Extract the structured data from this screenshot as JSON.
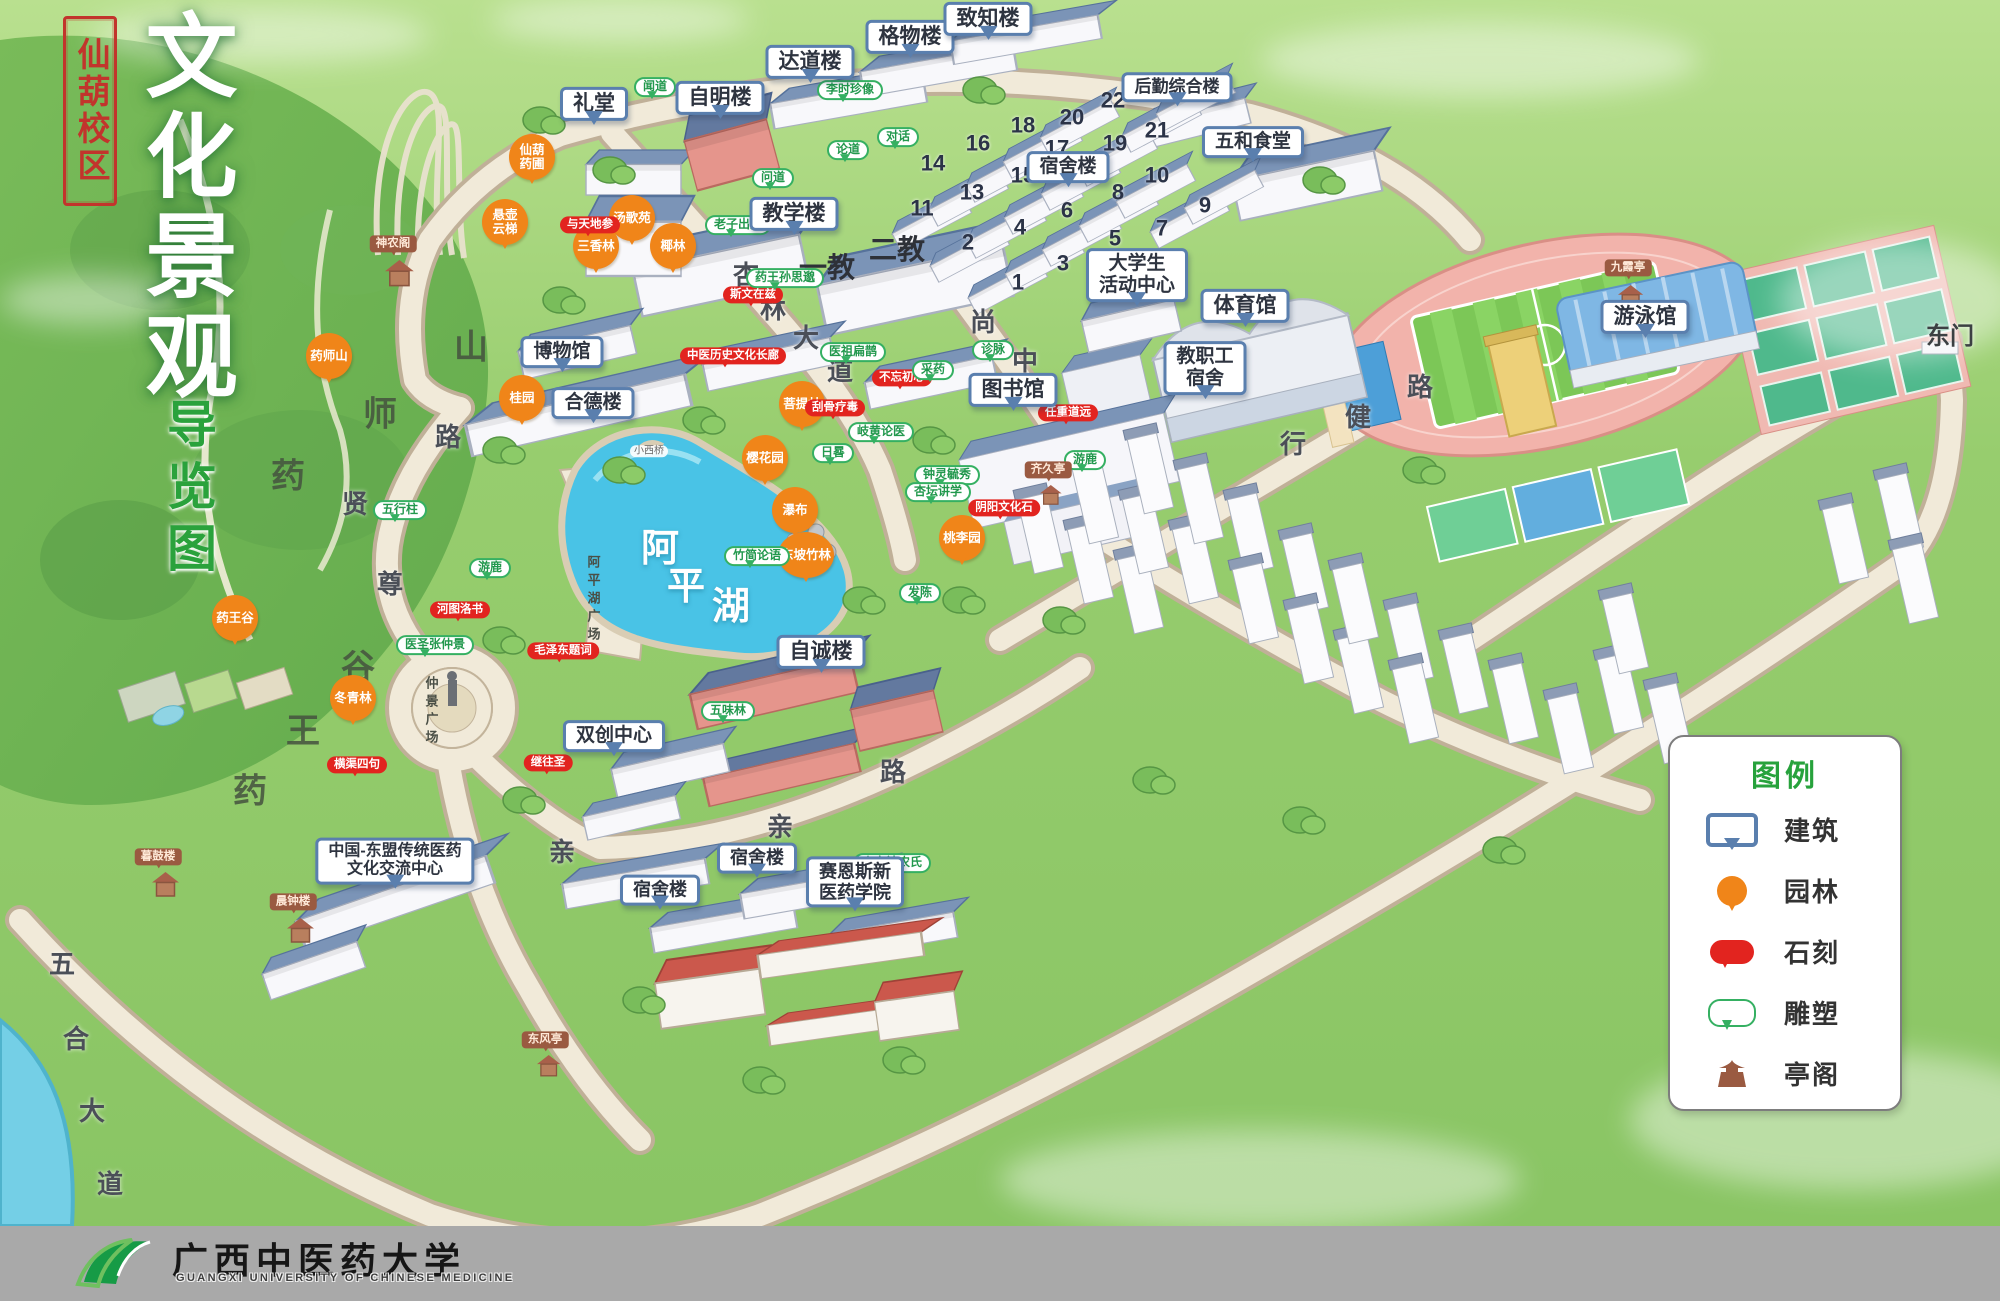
{
  "title": {
    "campus": "仙葫校区",
    "main": "文化景观",
    "sub": "导览图"
  },
  "legend": {
    "title": "图例",
    "items": [
      {
        "icon": "building-callout-icon",
        "label": "建筑"
      },
      {
        "icon": "garden-pin-icon",
        "label": "园林"
      },
      {
        "icon": "stone-bubble-icon",
        "label": "石刻"
      },
      {
        "icon": "sculpture-bubble-icon",
        "label": "雕塑"
      },
      {
        "icon": "pavilion-icon",
        "label": "亭阁"
      }
    ]
  },
  "footer": {
    "university": "广西中医药大学",
    "university_en": "GUANGXI UNIVERSITY OF CHINESE MEDICINE"
  },
  "lake": {
    "name": "阿平湖",
    "plaza": "阿平湖广场",
    "bridge": "小西桥"
  },
  "plaza": {
    "name": "仲景广场"
  },
  "colors": {
    "building_border": "#5a7fae",
    "garden_pin": "#f08519",
    "stone_label": "#e2241f",
    "sculpture_label": "#35b062",
    "pavilion_label": "#9a5a41",
    "legend_green": "#27a23c",
    "seal_red": "#c2342c",
    "footer_bar": "#a9a9a9",
    "lake": "#49c3e6",
    "road": "#f0e9d8",
    "grass": "#96cb6d"
  },
  "markers": {
    "buildings": [
      {
        "label": "礼堂",
        "x": 594,
        "y": 104
      },
      {
        "label": "自明楼",
        "x": 720,
        "y": 98
      },
      {
        "label": "达道楼",
        "x": 810,
        "y": 62
      },
      {
        "label": "格物楼",
        "x": 910,
        "y": 37
      },
      {
        "label": "致知楼",
        "x": 988,
        "y": 19
      },
      {
        "label": "后勤综合楼",
        "x": 1177,
        "y": 87,
        "fs": 17
      },
      {
        "label": "五和食堂",
        "x": 1253,
        "y": 142,
        "fs": 19
      },
      {
        "label": "宿舍楼",
        "x": 1068,
        "y": 167,
        "fs": 19
      },
      {
        "label": "教学楼",
        "x": 794,
        "y": 214
      },
      {
        "label": "大学生\n活动中心",
        "x": 1137,
        "y": 275,
        "fs": 19
      },
      {
        "label": "体育馆",
        "x": 1245,
        "y": 306
      },
      {
        "label": "图书馆",
        "x": 1013,
        "y": 390
      },
      {
        "label": "游泳馆",
        "x": 1645,
        "y": 317
      },
      {
        "label": "教职工\n宿舍",
        "x": 1205,
        "y": 368,
        "fs": 19
      },
      {
        "label": "自诚楼",
        "x": 821,
        "y": 652
      },
      {
        "label": "双创中心",
        "x": 614,
        "y": 736,
        "fs": 19
      },
      {
        "label": "宿舍楼",
        "x": 660,
        "y": 890,
        "fs": 18
      },
      {
        "label": "宿舍楼",
        "x": 757,
        "y": 858,
        "fs": 18
      },
      {
        "label": "赛恩斯新\n医药学院",
        "x": 855,
        "y": 882,
        "fs": 18
      },
      {
        "label": "博物馆",
        "x": 562,
        "y": 352,
        "fs": 19
      },
      {
        "label": "合德楼",
        "x": 593,
        "y": 403,
        "fs": 19
      },
      {
        "label": "中国-东盟传统医药\n文化交流中心",
        "x": 395,
        "y": 861,
        "fs": 16
      }
    ],
    "gardens": [
      {
        "label": "仙葫\n药圃",
        "x": 532,
        "y": 157
      },
      {
        "label": "悬壶\n云梯",
        "x": 505,
        "y": 222
      },
      {
        "label": "汤歌苑",
        "x": 632,
        "y": 218
      },
      {
        "label": "三香林",
        "x": 596,
        "y": 246
      },
      {
        "label": "椰林",
        "x": 673,
        "y": 246
      },
      {
        "label": "药师山",
        "x": 329,
        "y": 356
      },
      {
        "label": "桂园",
        "x": 522,
        "y": 398
      },
      {
        "label": "菩提林",
        "x": 802,
        "y": 404
      },
      {
        "label": "樱花园",
        "x": 765,
        "y": 458
      },
      {
        "label": "瀑布",
        "x": 795,
        "y": 510
      },
      {
        "label": "桃李园",
        "x": 962,
        "y": 538
      },
      {
        "label": "东坡竹林",
        "x": 806,
        "y": 555
      },
      {
        "label": "药王谷",
        "x": 235,
        "y": 618
      },
      {
        "label": "冬青林",
        "x": 353,
        "y": 698
      }
    ],
    "stones": [
      {
        "label": "与天地参",
        "x": 590,
        "y": 225
      },
      {
        "label": "斯文在兹",
        "x": 753,
        "y": 295
      },
      {
        "label": "中医历史文化长廊",
        "x": 733,
        "y": 356
      },
      {
        "label": "不忘初心",
        "x": 902,
        "y": 378
      },
      {
        "label": "刮骨疗毒",
        "x": 835,
        "y": 408
      },
      {
        "label": "任重道远",
        "x": 1068,
        "y": 413
      },
      {
        "label": "阴阳文化石",
        "x": 1004,
        "y": 508
      },
      {
        "label": "河图洛书",
        "x": 460,
        "y": 610
      },
      {
        "label": "毛泽东题词",
        "x": 563,
        "y": 651
      },
      {
        "label": "横渠四句",
        "x": 357,
        "y": 765
      },
      {
        "label": "继往圣",
        "x": 548,
        "y": 763
      }
    ],
    "sculptures": [
      {
        "label": "闻道",
        "x": 655,
        "y": 87
      },
      {
        "label": "李时珍像",
        "x": 850,
        "y": 90
      },
      {
        "label": "对话",
        "x": 898,
        "y": 137
      },
      {
        "label": "论道",
        "x": 848,
        "y": 150
      },
      {
        "label": "问道",
        "x": 773,
        "y": 178
      },
      {
        "label": "老子出关",
        "x": 738,
        "y": 225
      },
      {
        "label": "药王孙思邈",
        "x": 785,
        "y": 278
      },
      {
        "label": "医祖扁鹊",
        "x": 853,
        "y": 352
      },
      {
        "label": "诊脉",
        "x": 993,
        "y": 350
      },
      {
        "label": "采药",
        "x": 933,
        "y": 370
      },
      {
        "label": "岐黄论医",
        "x": 881,
        "y": 432
      },
      {
        "label": "日晷",
        "x": 833,
        "y": 453
      },
      {
        "label": "游鹿",
        "x": 1085,
        "y": 460
      },
      {
        "label": "钟灵毓秀",
        "x": 947,
        "y": 475
      },
      {
        "label": "杏坛讲学",
        "x": 938,
        "y": 492
      },
      {
        "label": "五行柱",
        "x": 400,
        "y": 510
      },
      {
        "label": "竹简论语",
        "x": 757,
        "y": 556
      },
      {
        "label": "游鹿",
        "x": 490,
        "y": 568
      },
      {
        "label": "发陈",
        "x": 920,
        "y": 593
      },
      {
        "label": "医圣张仲景",
        "x": 435,
        "y": 645
      },
      {
        "label": "五味林",
        "x": 728,
        "y": 711
      },
      {
        "label": "炎帝神农氏",
        "x": 892,
        "y": 863
      }
    ],
    "pavilions": [
      {
        "label": "神农阁",
        "x": 393,
        "y": 244
      },
      {
        "label": "九霞亭",
        "x": 1628,
        "y": 268
      },
      {
        "label": "齐久亭",
        "x": 1048,
        "y": 470
      },
      {
        "label": "东风亭",
        "x": 545,
        "y": 1040
      },
      {
        "label": "暮鼓楼",
        "x": 158,
        "y": 857
      },
      {
        "label": "晨钟楼",
        "x": 293,
        "y": 902
      }
    ],
    "road_chars": [
      {
        "ch": "杏",
        "x": 746,
        "y": 276
      },
      {
        "ch": "林",
        "x": 773,
        "y": 310
      },
      {
        "ch": "大",
        "x": 806,
        "y": 339
      },
      {
        "ch": "道",
        "x": 840,
        "y": 372
      },
      {
        "ch": "尚",
        "x": 983,
        "y": 323
      },
      {
        "ch": "中",
        "x": 1025,
        "y": 362
      },
      {
        "ch": "行",
        "x": 1293,
        "y": 445
      },
      {
        "ch": "健",
        "x": 1358,
        "y": 418
      },
      {
        "ch": "路",
        "x": 1420,
        "y": 388
      },
      {
        "ch": "路",
        "x": 448,
        "y": 438
      },
      {
        "ch": "贤",
        "x": 355,
        "y": 505
      },
      {
        "ch": "尊",
        "x": 390,
        "y": 585
      },
      {
        "ch": "亲",
        "x": 562,
        "y": 853
      },
      {
        "ch": "亲",
        "x": 780,
        "y": 828
      },
      {
        "ch": "路",
        "x": 893,
        "y": 773
      },
      {
        "ch": "五",
        "x": 62,
        "y": 965
      },
      {
        "ch": "合",
        "x": 76,
        "y": 1040
      },
      {
        "ch": "大",
        "x": 92,
        "y": 1112
      },
      {
        "ch": "道",
        "x": 110,
        "y": 1185
      }
    ],
    "terrain_chars": [
      {
        "ch": "药",
        "x": 288,
        "y": 477
      },
      {
        "ch": "师",
        "x": 380,
        "y": 415
      },
      {
        "ch": "山",
        "x": 471,
        "y": 348
      },
      {
        "ch": "谷",
        "x": 358,
        "y": 668
      },
      {
        "ch": "王",
        "x": 303,
        "y": 732
      },
      {
        "ch": "药",
        "x": 250,
        "y": 792
      }
    ],
    "lake_chars": [
      {
        "ch": "阿",
        "x": 660,
        "y": 550
      },
      {
        "ch": "平",
        "x": 686,
        "y": 588
      },
      {
        "ch": "湖",
        "x": 731,
        "y": 608
      }
    ],
    "numbers": [
      {
        "n": "1",
        "x": 1018,
        "y": 282
      },
      {
        "n": "2",
        "x": 968,
        "y": 242
      },
      {
        "n": "3",
        "x": 1063,
        "y": 263
      },
      {
        "n": "4",
        "x": 1020,
        "y": 227
      },
      {
        "n": "5",
        "x": 1115,
        "y": 238
      },
      {
        "n": "6",
        "x": 1067,
        "y": 210
      },
      {
        "n": "7",
        "x": 1162,
        "y": 228
      },
      {
        "n": "8",
        "x": 1118,
        "y": 192
      },
      {
        "n": "9",
        "x": 1205,
        "y": 205
      },
      {
        "n": "10",
        "x": 1157,
        "y": 175
      },
      {
        "n": "11",
        "x": 922,
        "y": 208
      },
      {
        "n": "13",
        "x": 972,
        "y": 192
      },
      {
        "n": "14",
        "x": 933,
        "y": 163
      },
      {
        "n": "15",
        "x": 1023,
        "y": 175
      },
      {
        "n": "16",
        "x": 978,
        "y": 143
      },
      {
        "n": "17",
        "x": 1057,
        "y": 148
      },
      {
        "n": "18",
        "x": 1023,
        "y": 125
      },
      {
        "n": "19",
        "x": 1115,
        "y": 143
      },
      {
        "n": "20",
        "x": 1072,
        "y": 117
      },
      {
        "n": "21",
        "x": 1157,
        "y": 130
      },
      {
        "n": "22",
        "x": 1113,
        "y": 100
      }
    ],
    "areas": [
      {
        "label": "一教",
        "x": 827,
        "y": 268
      },
      {
        "label": "二教",
        "x": 897,
        "y": 250
      }
    ],
    "gates": [
      {
        "label": "东门",
        "x": 1950,
        "y": 337
      }
    ]
  }
}
